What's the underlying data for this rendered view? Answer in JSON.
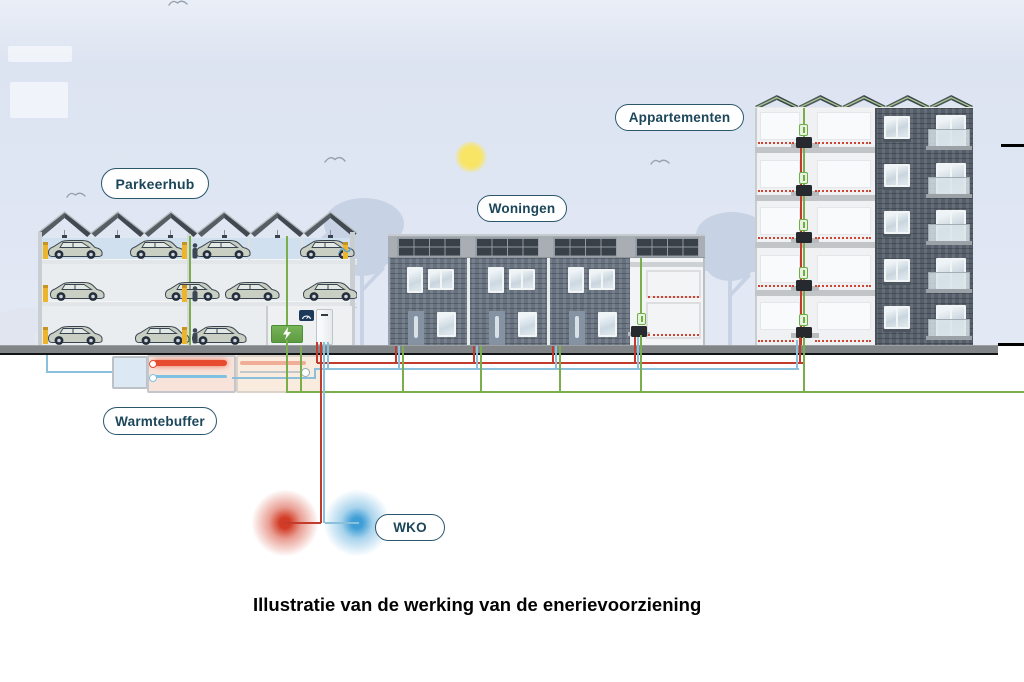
{
  "title": "Illustratie van de werking van de enerievoorziening",
  "labels": {
    "parkeerhub": "Parkeerhub",
    "woningen": "Woningen",
    "appartementen": "Appartementen",
    "warmtebuffer": "Warmtebuffer",
    "wko": "WKO"
  },
  "colors": {
    "electricity_line": "#79ae4b",
    "heat_pipe": "#c23b2b",
    "cold_pipe": "#8ac0dc",
    "label_ink": "#1c4659",
    "label_border": "#2b566c",
    "sun": "#f6e163",
    "wko_warm_well": "#d23c26",
    "wko_cold_well": "#3f9ed6",
    "ground": "#828587",
    "battery_green": "#6ab04c"
  },
  "icons": {
    "sun_icon": "yellow radial circle",
    "bird_icon": "gull double-arc",
    "lightning_bolt_icon": "white bolt on green battery",
    "gauge_icon": "white dial arc on navy meter box",
    "tree_icon": "pale blue silhouette"
  }
}
